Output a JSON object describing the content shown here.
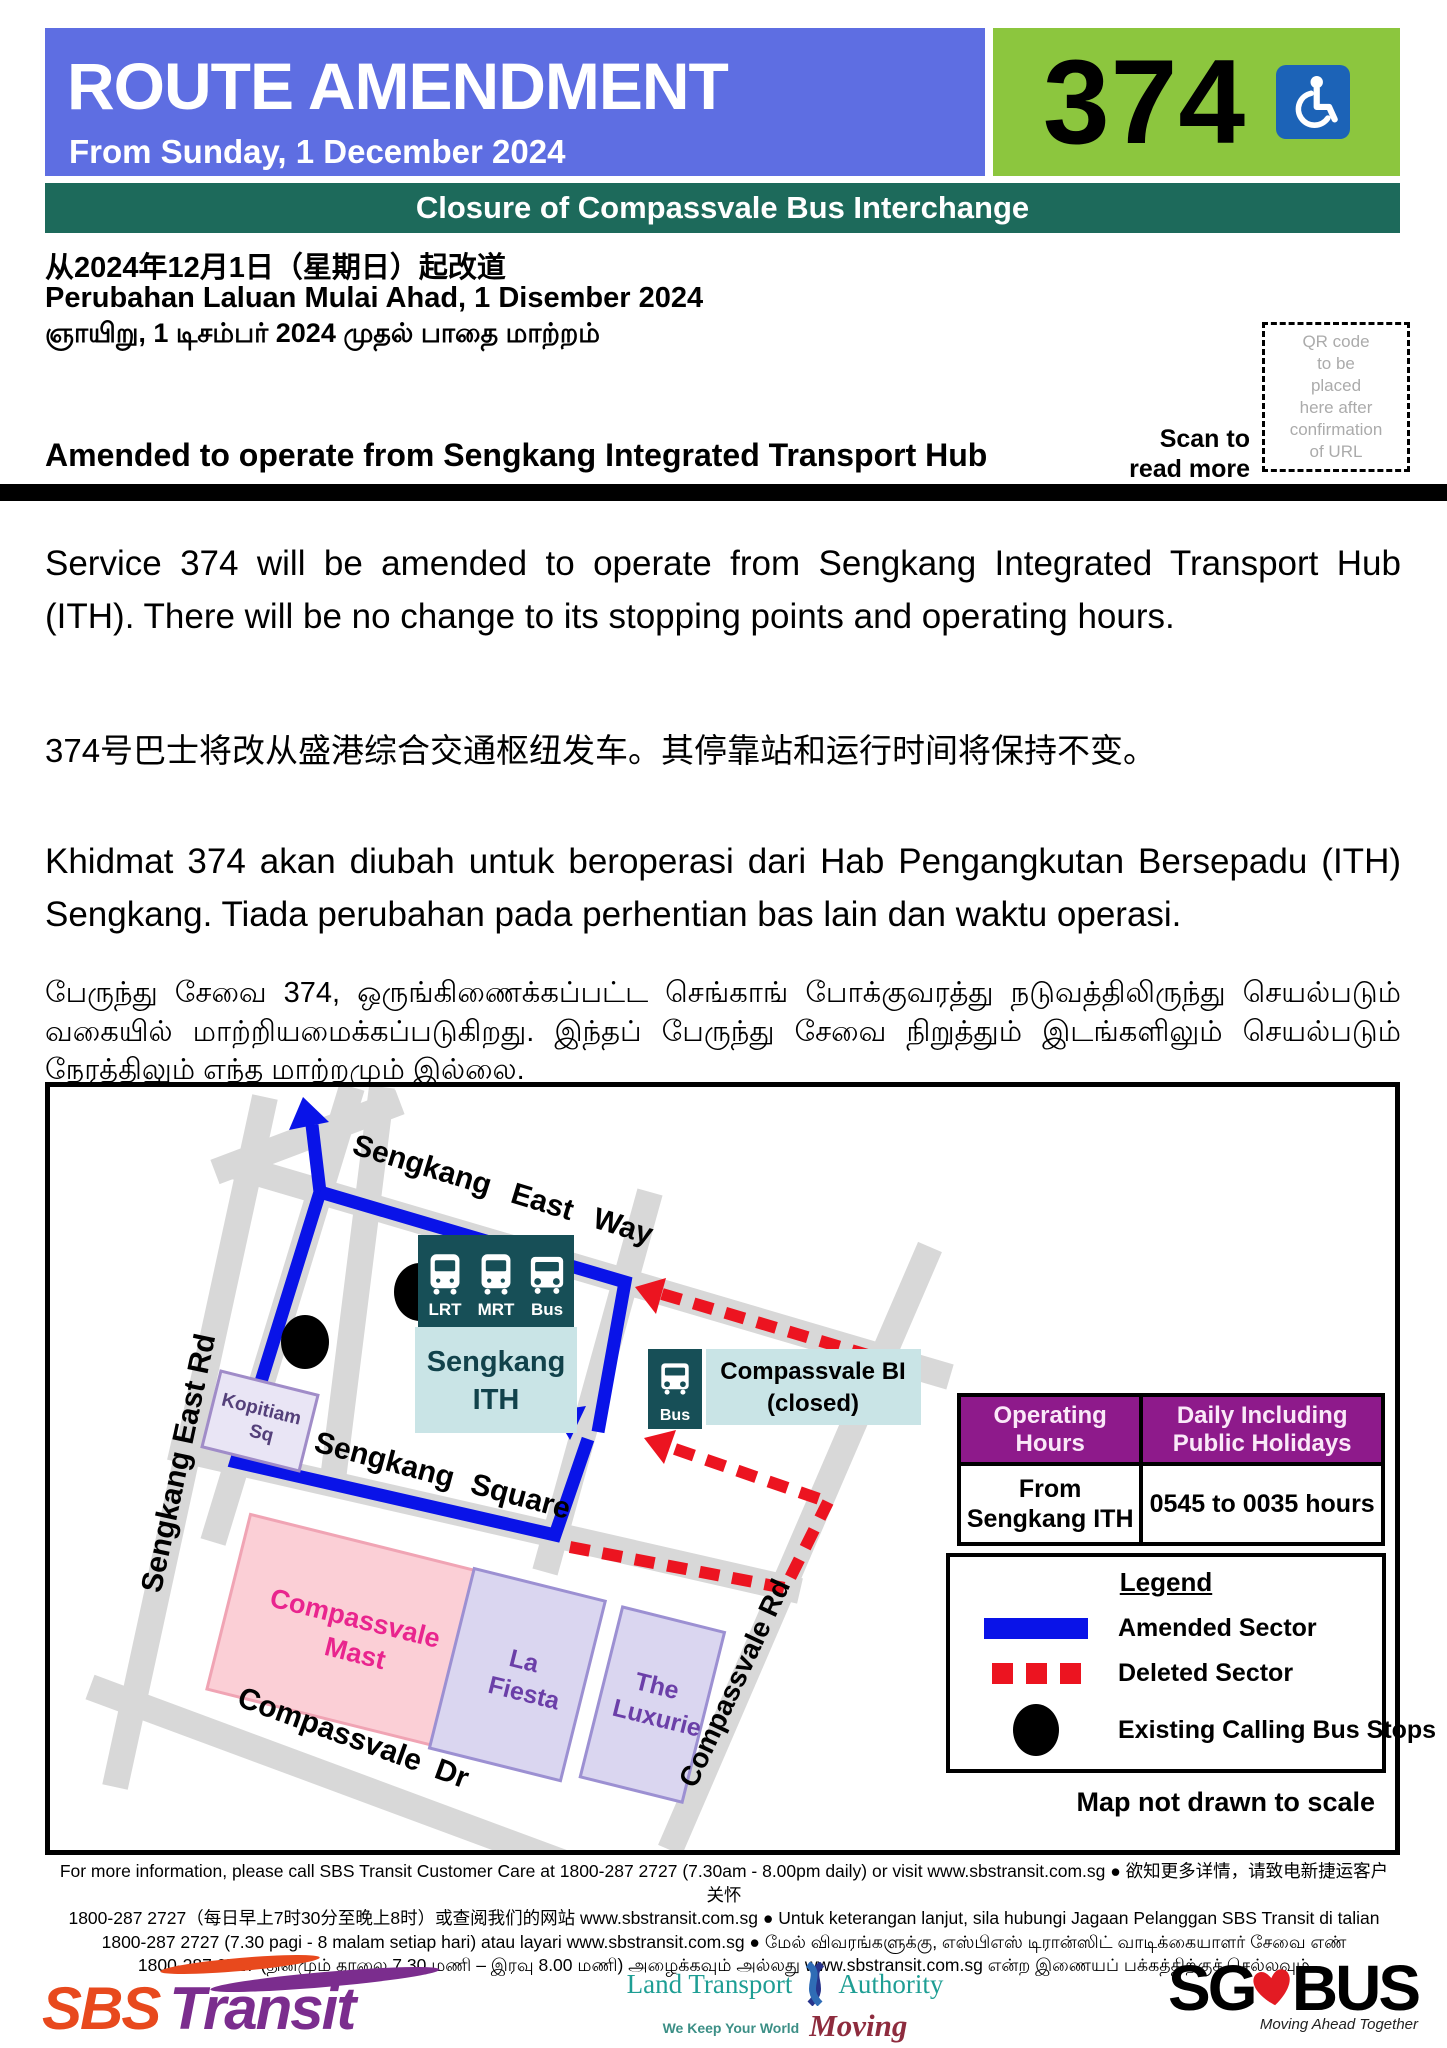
{
  "header": {
    "title": "ROUTE AMENDMENT",
    "date_line": "From Sunday, 1 December 2024",
    "service_number": "374",
    "banner": "Closure of Compassvale Bus Interchange"
  },
  "subheader": {
    "chinese": "从2024年12月1日（星期日）起改道",
    "malay": "Perubahan Laluan Mulai Ahad, 1 Disember 2024",
    "tamil": "ஞாயிறு, 1 டிசம்பர் 2024 முதல் பாதை மாற்றம்",
    "english_headline": "Amended to operate from Sengkang Integrated Transport Hub",
    "scan_line1": "Scan to",
    "scan_line2": "read more",
    "qr_placeholder": "QR code\nto be\nplaced\nhere after\nconfirmation\nof URL"
  },
  "body": {
    "english": "Service 374 will be amended to operate from Sengkang Integrated Transport Hub (ITH). There will be no change to its stopping points and operating hours.",
    "chinese": "374号巴士将改从盛港综合交通枢纽发车。其停靠站和运行时间将保持不变。",
    "malay": "Khidmat 374 akan diubah untuk beroperasi dari Hab Pengangkutan Bersepadu (ITH) Sengkang. Tiada perubahan pada perhentian bas lain dan waktu operasi.",
    "tamil": "பேருந்து சேவை 374, ஒருங்கிணைக்கப்பட்ட செங்காங் போக்குவரத்து நடுவத்திலிருந்து செயல்படும் வகையில் மாற்றியமைக்கப்படுகிறது. இந்தப் பேருந்து சேவை நிறுத்தும் இடங்களிலும் செயல்படும் நேரத்திலும் எந்த மாற்றமும் இல்லை."
  },
  "map": {
    "road_sengkang_east_way": "Sengkang East Way",
    "road_sengkang_square": "Sengkang Square",
    "road_sengkang_east_rd": "Sengkang East Rd",
    "road_compassvale_dr": "Compassvale Dr",
    "road_compassvale_rd": "Compassvale Rd",
    "ith_icon_labels": [
      "LRT",
      "MRT",
      "Bus"
    ],
    "ith_name_line1": "Sengkang",
    "ith_name_line2": "ITH",
    "bi_icon_label": "Bus",
    "bi_line1": "Compassvale BI",
    "bi_line2": "(closed)",
    "bldg_mast_line1": "Compassvale",
    "bldg_mast_line2": "Mast",
    "bldg_kopitiam_line1": "Kopitiam",
    "bldg_kopitiam_line2": "Sq",
    "bldg_fiesta_line1": "La",
    "bldg_fiesta_line2": "Fiesta",
    "bldg_luxurie_line1": "The",
    "bldg_luxurie_line2": "Luxurie",
    "note": "Map not drawn to scale"
  },
  "table": {
    "headers": [
      "Operating Hours",
      "Daily Including Public Holidays"
    ],
    "row": [
      "From Sengkang ITH",
      "0545 to 0035 hours"
    ]
  },
  "legend": {
    "title": "Legend",
    "amended": "Amended Sector",
    "deleted": "Deleted Sector",
    "stops": "Existing Calling Bus Stops"
  },
  "footer": {
    "lines": [
      "For more information, please call SBS Transit Customer Care at 1800-287 2727 (7.30am - 8.00pm daily) or visit www.sbstransit.com.sg ● 欲知更多详情，请致电新捷运客户关怀",
      "1800-287 2727（每日早上7时30分至晚上8时）或查阅我们的网站 www.sbstransit.com.sg ● Untuk keterangan lanjut, sila hubungi Jagaan Pelanggan SBS Transit di talian",
      "1800-287 2727 (7.30 pagi - 8 malam setiap hari) atau layari www.sbstransit.com.sg ● மேல் விவரங்களுக்கு, எஸ்பிஎஸ் டிரான்ஸிட் வாடிக்கையாளர் சேவை எண்",
      "1800-287 2727 (தினமும் காலை 7.30 மணி – இரவு 8.00 மணி) அழைக்கவும் அல்லது www.sbstransit.com.sg என்ற இணையப் பக்கத்திற்குச் செல்லவும்"
    ]
  },
  "logos": {
    "sbs": {
      "part1": "SBS",
      "part2": "Transit"
    },
    "lta": {
      "line1": "Land Transport",
      "line2": "Authority",
      "tagline": "We Keep Your World",
      "moving": "Moving"
    },
    "sgbus": {
      "part1": "SG",
      "part2": "BUS",
      "tagline": "Moving Ahead Together"
    }
  },
  "colors": {
    "header_blue": "#5E6EE2",
    "service_green": "#8CC63E",
    "banner_teal": "#1D6A5B",
    "table_purple": "#8E1A8B",
    "amended_blue": "#0913E8",
    "deleted_red": "#EC1420",
    "road_gray": "#D8D8D8",
    "ith_dark_teal": "#174F57",
    "ith_light_teal": "#C9E4E6",
    "wheelchair_blue": "#1C63B7"
  }
}
